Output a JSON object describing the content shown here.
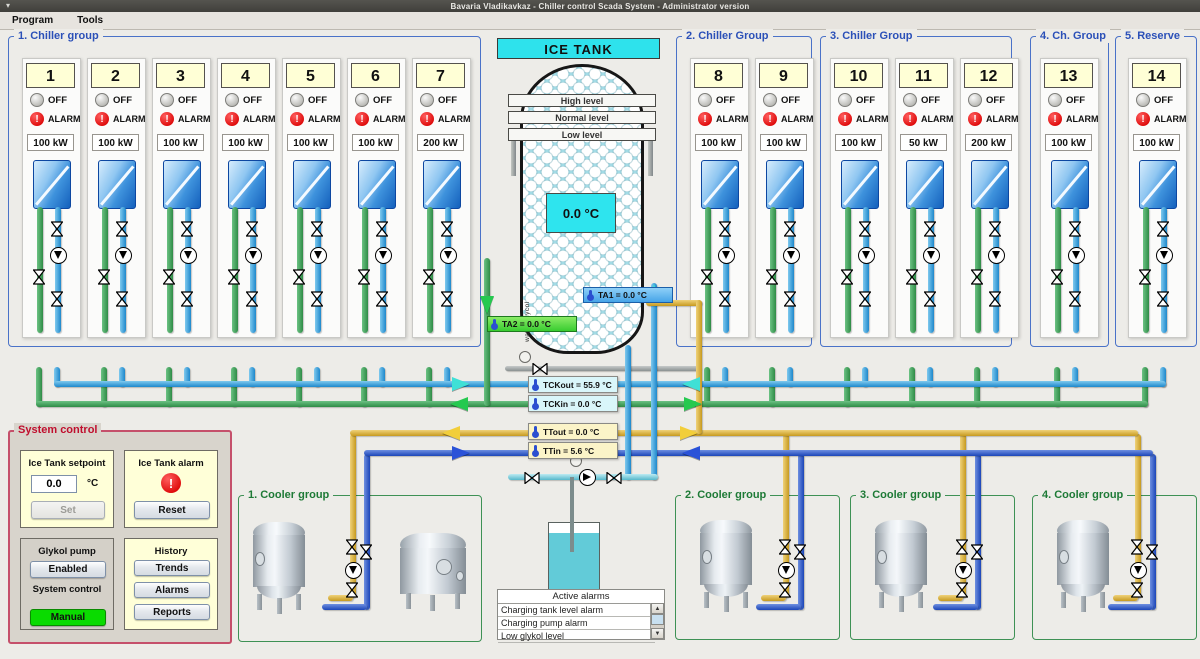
{
  "window": {
    "title": "Bavaria Vladikavkaz - Chiller control Scada System - Administrator version"
  },
  "menu": {
    "items": [
      {
        "label": "Program"
      },
      {
        "label": "Tools"
      }
    ]
  },
  "indicators": {
    "off": "OFF",
    "alarm": "ALARM"
  },
  "icons": {
    "alarm_glyph": "!",
    "scroll_up": "▲",
    "scroll_down": "▼"
  },
  "chiller_groups": [
    {
      "title": "1. Chiller group",
      "chillers": [
        {
          "number": "1",
          "power": "100 kW"
        },
        {
          "number": "2",
          "power": "100 kW"
        },
        {
          "number": "3",
          "power": "100 kW"
        },
        {
          "number": "4",
          "power": "100 kW"
        },
        {
          "number": "5",
          "power": "100 kW"
        },
        {
          "number": "6",
          "power": "100 kW"
        },
        {
          "number": "7",
          "power": "200 kW"
        }
      ]
    },
    {
      "title": "2. Chiller Group",
      "chillers": [
        {
          "number": "8",
          "power": "100 kW"
        },
        {
          "number": "9",
          "power": "100 kW"
        }
      ]
    },
    {
      "title": "3. Chiller Group",
      "chillers": [
        {
          "number": "10",
          "power": "100 kW"
        },
        {
          "number": "11",
          "power": "50 kW"
        },
        {
          "number": "12",
          "power": "200 kW"
        }
      ]
    },
    {
      "title": "4. Ch. Group",
      "chillers": [
        {
          "number": "13",
          "power": "100 kW"
        }
      ]
    },
    {
      "title": "5. Reserve",
      "chillers": [
        {
          "number": "14",
          "power": "100 kW"
        }
      ]
    }
  ],
  "ice_tank": {
    "title": "ICE TANK",
    "levels": [
      "High level",
      "Normal level",
      "Low level"
    ],
    "temperature": "0.0 °C",
    "side_label": "water-glycol",
    "sensors": {
      "ta1": "TA1 = 0.0 °C",
      "ta2": "TA2 = 0.0 °C"
    }
  },
  "pipe_sensors": {
    "tckout": "TCKout = 55.9 °C",
    "tckin": "TCKin = 0.0 °C",
    "ttout": "TTout = 0.0 °C",
    "ttin": "TTin = 5.6 °C"
  },
  "system_control": {
    "title": "System control",
    "setpoint": {
      "title": "Ice Tank setpoint",
      "value": "0.0",
      "unit": "°C",
      "set_label": "Set"
    },
    "alarm": {
      "title": "Ice Tank alarm",
      "reset_label": "Reset"
    },
    "pump": {
      "title": "Glykol pump",
      "state_label": "Enabled",
      "control_title": "System control",
      "mode_label": "Manual"
    },
    "history": {
      "title": "History",
      "buttons": [
        "Trends",
        "Alarms",
        "Reports"
      ]
    }
  },
  "cooler_groups": [
    {
      "title": "1. Cooler group"
    },
    {
      "title": "2. Cooler group"
    },
    {
      "title": "3. Cooler group"
    },
    {
      "title": "4. Cooler group"
    }
  ],
  "alarms": {
    "title": "Active alarms",
    "items": [
      "Charging tank level alarm",
      "Charging pump alarm",
      "Low glykol level"
    ]
  }
}
